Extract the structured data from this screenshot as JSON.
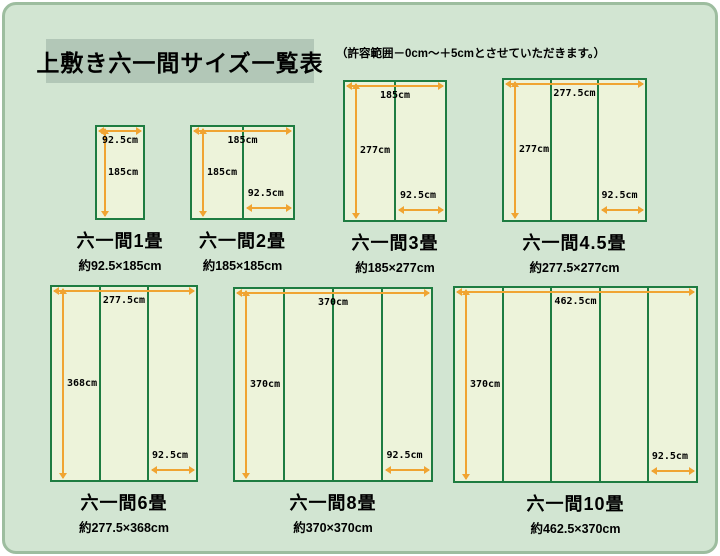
{
  "page": {
    "title": "上敷き六一間サイズ一覧表",
    "note": "（許容範囲－0cm～＋5cmとさせていただきます。）",
    "colors": {
      "page_bg": "#ffffff",
      "panel_bg": "#d2e5d2",
      "panel_border": "#9dbd9f",
      "title_bg": "#b2c7b7",
      "mat_fill": "#edf3da",
      "mat_border": "#1e7c41",
      "arrow": "#f0a432",
      "text": "#000000"
    }
  },
  "diagrams": [
    {
      "id": "1jo",
      "name": "六一間1畳",
      "size_label": "約92.5×185cm",
      "width_label": "92.5cm",
      "height_label": "185cm",
      "panels": 1
    },
    {
      "id": "2jo",
      "name": "六一間2畳",
      "size_label": "約185×185cm",
      "width_label": "185cm",
      "height_label": "185cm",
      "partial_label": "92.5cm",
      "panels": 2
    },
    {
      "id": "3jo",
      "name": "六一間3畳",
      "size_label": "約185×277cm",
      "width_label": "185cm",
      "height_label": "277cm",
      "partial_label": "92.5cm",
      "panels": 2
    },
    {
      "id": "4_5jo",
      "name": "六一間4.5畳",
      "size_label": "約277.5×277cm",
      "width_label": "277.5cm",
      "height_label": "277cm",
      "partial_label": "92.5cm",
      "panels": 3
    },
    {
      "id": "6jo",
      "name": "六一間6畳",
      "size_label": "約277.5×368cm",
      "width_label": "277.5cm",
      "height_label": "368cm",
      "partial_label": "92.5cm",
      "panels": 3
    },
    {
      "id": "8jo",
      "name": "六一間8畳",
      "size_label": "約370×370cm",
      "width_label": "370cm",
      "height_label": "370cm",
      "partial_label": "92.5cm",
      "panels": 4
    },
    {
      "id": "10jo",
      "name": "六一間10畳",
      "size_label": "約462.5×370cm",
      "width_label": "462.5cm",
      "height_label": "370cm",
      "partial_label": "92.5cm",
      "panels": 5
    }
  ]
}
